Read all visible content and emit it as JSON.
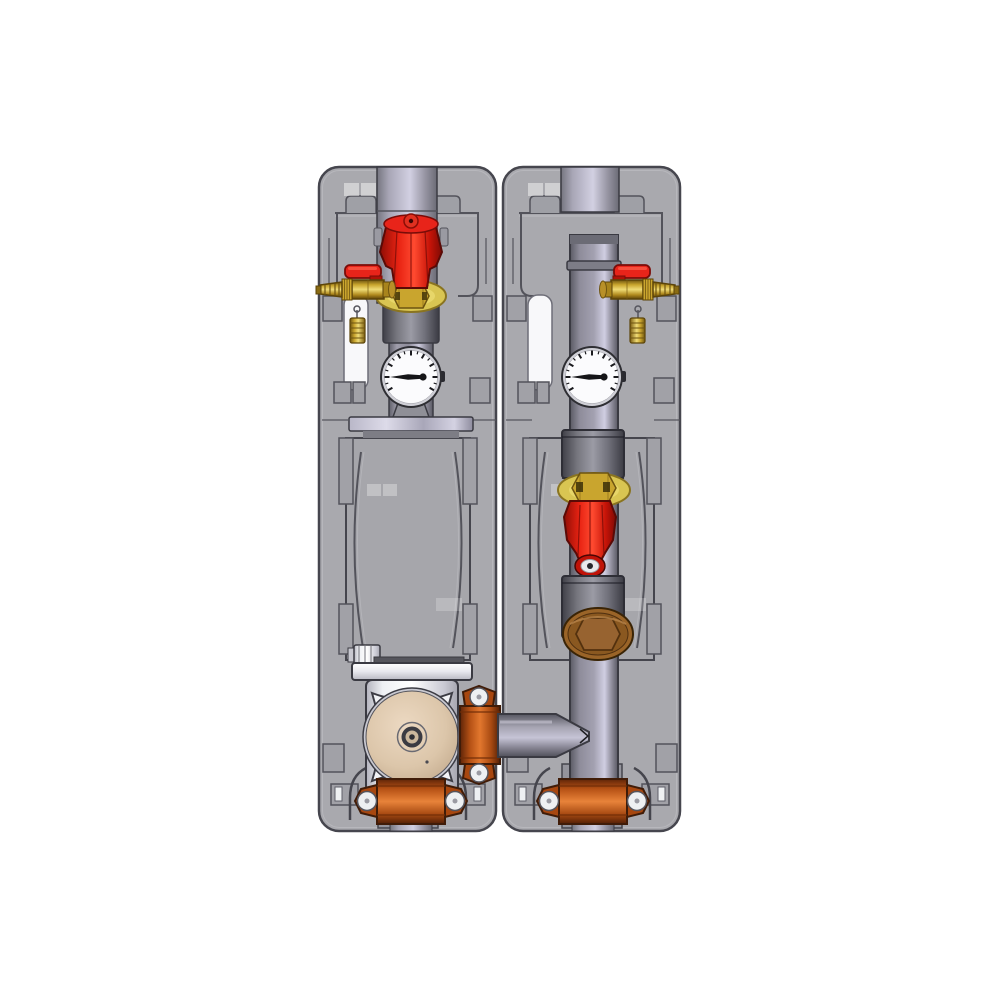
{
  "scene": {
    "description": "CAD render of an insulated two-line heating pump group",
    "background": "#ffffff"
  },
  "colors": {
    "shell": "#a9a9ae",
    "shell_line": "#53535b",
    "outline": "#3a3a42",
    "slot_white": "#f8f8fa",
    "pipe_highlight": "#cdcbde",
    "pipe_mid": "#8f8d9b",
    "pipe_dark": "#5f5f69",
    "valve_red": "#e8241a",
    "valve_red_dark": "#7e0a04",
    "brass": "#d9c552",
    "brass_nut": "#c9a52e",
    "copper": "#c2601e",
    "bronze_plug": "#9a6428",
    "pump_face_tan": "#d9c2a6",
    "pump_body_white": "#f2f3f6",
    "gauge_face": "#fbfbfd",
    "gauge_needle": "#151518"
  },
  "components": {
    "left_line": [
      "insulation-shell",
      "top-pipe-stub",
      "shutoff-valve-red-knob",
      "brass-flange-disc",
      "drain-valve-hose-barb",
      "thermometer-gauge",
      "flange-bar",
      "air-vent-fitting",
      "circulation-pump",
      "pump-face-plate",
      "side-coupling-clamp",
      "outlet-pipe",
      "bottom-coupling-clamp",
      "bottom-pipe-stub"
    ],
    "right_line": [
      "insulation-shell",
      "top-pipe-stub",
      "vertical-pipe",
      "drain-valve-hose-barb",
      "thermometer-gauge",
      "upper-sleeve",
      "brass-flange-disc",
      "check-valve-red-knob",
      "lower-sleeve",
      "bronze-hex-plug",
      "tee-junction",
      "bottom-coupling-clamp",
      "bottom-pipe-stub"
    ]
  },
  "gauges": {
    "left_needle_points": "west",
    "right_needle_points": "west"
  }
}
